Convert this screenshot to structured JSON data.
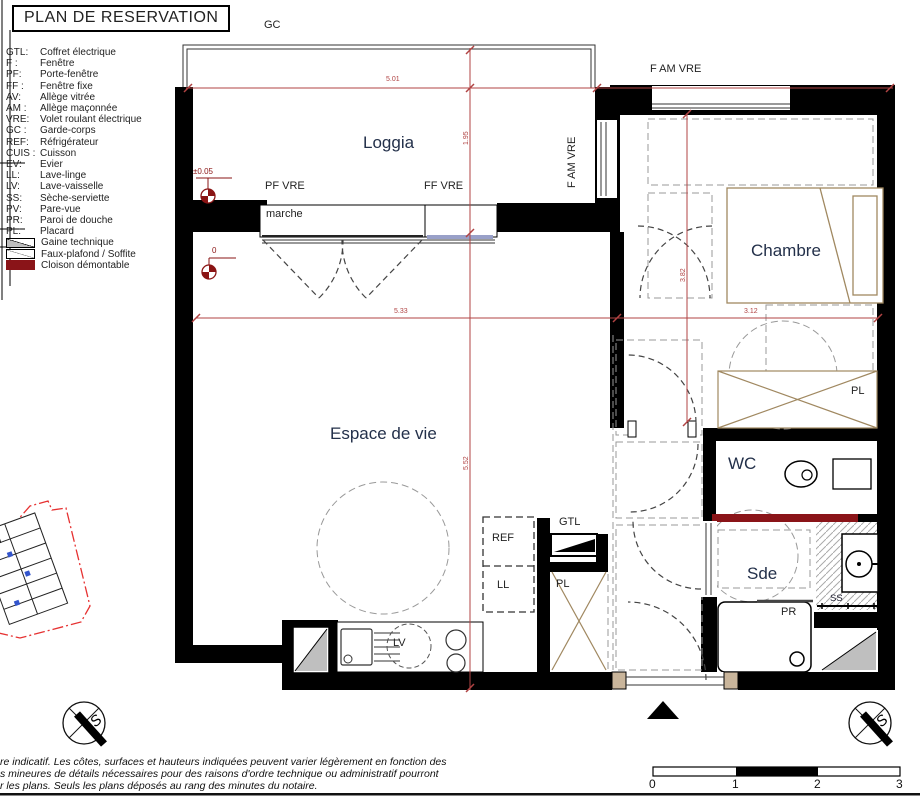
{
  "title": "PLAN DE RESERVATION",
  "legend": {
    "items": [
      {
        "abbr": "GTL:",
        "label": "Coffret électrique"
      },
      {
        "abbr": "F :",
        "label": "Fenêtre"
      },
      {
        "abbr": "PF:",
        "label": "Porte-fenêtre"
      },
      {
        "abbr": "FF :",
        "label": "Fenêtre fixe"
      },
      {
        "abbr": "AV:",
        "label": "Allège vitrée"
      },
      {
        "abbr": "AM :",
        "label": "Allège maçonnée"
      },
      {
        "abbr": "VRE:",
        "label": "Volet roulant électrique"
      },
      {
        "abbr": "GC :",
        "label": "Garde-corps"
      },
      {
        "abbr": "REF:",
        "label": "Réfrigérateur"
      },
      {
        "abbr": "CUIS :",
        "label": "Cuisson"
      },
      {
        "abbr": "EV:",
        "label": "Evier"
      },
      {
        "abbr": "LL:",
        "label": "Lave-linge"
      },
      {
        "abbr": "LV:",
        "label": "Lave-vaisselle"
      },
      {
        "abbr": "SS:",
        "label": "Sèche-serviette"
      },
      {
        "abbr": "PV:",
        "label": "Pare-vue"
      },
      {
        "abbr": "PR:",
        "label": "Paroi de douche"
      },
      {
        "abbr": "PL:",
        "label": "Placard"
      }
    ],
    "swatches": [
      {
        "name": "gaine-technique",
        "label": "Gaine technique"
      },
      {
        "name": "faux-plafond",
        "label": "Faux-plafond / Soffite"
      },
      {
        "name": "cloison-demontable",
        "label": "Cloison démontable"
      }
    ]
  },
  "plan": {
    "rooms": {
      "loggia": "Loggia",
      "chambre": "Chambre",
      "espace": "Espace de vie",
      "wc": "WC",
      "sde": "Sde"
    },
    "labels": {
      "gc": "GC",
      "f_am_vre_top": "F AM VRE",
      "f_am_vre_left": "F AM VRE",
      "pf_vre": "PF VRE",
      "ff_vre": "FF VRE",
      "marche": "marche",
      "ref": "REF",
      "ll": "LL",
      "lv": "LV",
      "gtl": "GTL",
      "pl_chambre": "PL",
      "pl_entree": "PL",
      "pr": "PR",
      "ss": "SS"
    },
    "dimensions": {
      "w_top": "5.01",
      "d_loggia": "1.95",
      "w_living": "5.33",
      "h_living": "5.52",
      "h_chambre": "3.82",
      "w_chambre": "3.12"
    },
    "levels": {
      "loggia": "±0.05",
      "interior": "0"
    },
    "compass_letter": "S"
  },
  "footer": {
    "disclaimer_lines": [
      "re indicatif. Les côtes, surfaces et hauteurs indiquées peuvent varier légèrement en fonction des",
      "s mineures de détails nécessaires pour des raisons d'ordre technique ou administratif pourront",
      "r les plans. Seuls les plans déposés au rang des minutes du notaire."
    ],
    "scale_ticks": [
      "0",
      "1",
      "2",
      "3"
    ]
  }
}
